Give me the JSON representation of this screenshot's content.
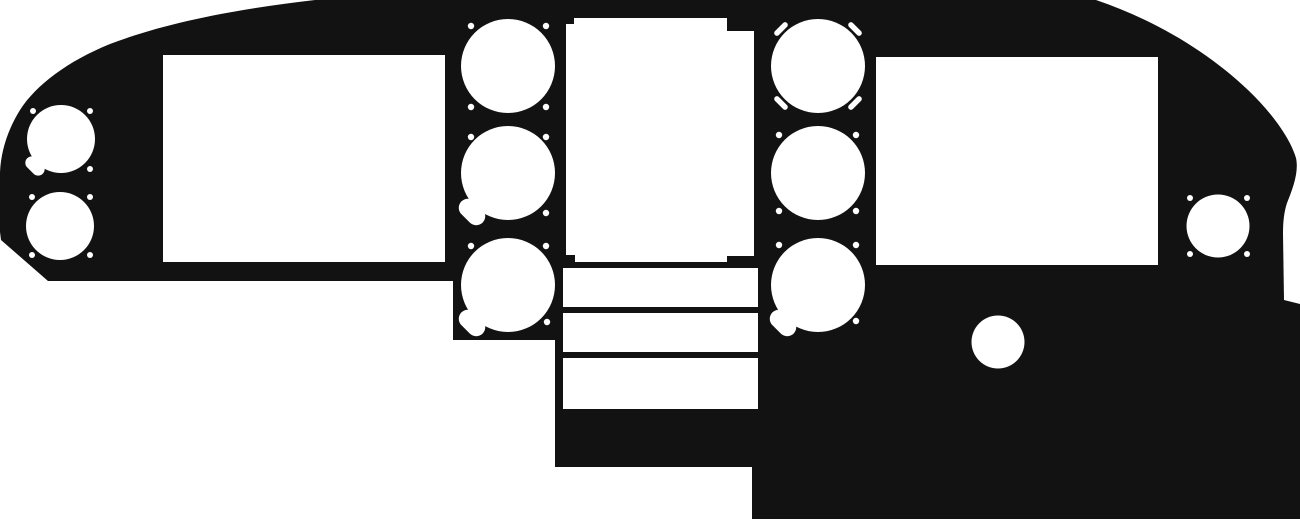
{
  "meta": {
    "title": "aircraft-instrument-panel-cutout-silhouette",
    "width": 1300,
    "height": 523
  },
  "colors": {
    "panel": "#121212",
    "cutout": "#ffffff",
    "background": "#ffffff"
  },
  "panel": {
    "outline_path": "M 315,0 L 1096,0 C 1155,20 1208,52 1248,90 C 1272,113 1290,138 1296,158 C 1299,172 1293,188 1287,203 C 1284,212 1283,222 1283,234 L 1284,300 L 1300,304 L 1300,519 L 752,519 L 752,467 L 555,467 L 555,340 L 453,340 L 453,281 L 48,281 L 1,240 L 0,232 L 0,172 C 1,152 7,131 20,110 C 36,85 68,61 110,44 C 168,22 238,9 315,0 Z",
    "display_cutouts": [
      {
        "name": "left-display-cutout",
        "x": 163,
        "y": 55,
        "w": 282,
        "h": 207
      },
      {
        "name": "right-display-cutout",
        "x": 876,
        "y": 57,
        "w": 282,
        "h": 208
      }
    ],
    "radio_stack": {
      "main": {
        "name": "radio-stack-cutout",
        "x": 566,
        "y": 18,
        "w": 188,
        "h": 244
      },
      "corner_notches": [
        {
          "name": "radio-notch-top-left",
          "x": 566,
          "y": 18,
          "w": 8,
          "h": 6
        },
        {
          "name": "radio-notch-top-right",
          "x": 727,
          "y": 18,
          "w": 27,
          "h": 13
        },
        {
          "name": "radio-notch-bottom-left",
          "x": 566,
          "y": 255,
          "w": 9,
          "h": 7
        },
        {
          "name": "radio-notch-bottom-right",
          "x": 727,
          "y": 256,
          "w": 27,
          "h": 6
        }
      ],
      "slots": [
        {
          "name": "radio-slot-1",
          "x": 563,
          "y": 268,
          "w": 195,
          "h": 39
        },
        {
          "name": "radio-slot-2",
          "x": 563,
          "y": 313,
          "w": 195,
          "h": 39
        },
        {
          "name": "radio-slot-3",
          "x": 563,
          "y": 358,
          "w": 195,
          "h": 51
        }
      ]
    },
    "instrument_cutouts": [
      {
        "name": "far-left-top-instrument",
        "cx": 61,
        "cy": 139,
        "r": 34,
        "notch": {
          "dx": -26,
          "dy": 27,
          "w": 22,
          "h": 13
        }
      },
      {
        "name": "far-left-bottom-instrument",
        "cx": 60,
        "cy": 226,
        "r": 34
      },
      {
        "name": "left-column-top-instrument",
        "cx": 508,
        "cy": 66,
        "r": 47
      },
      {
        "name": "left-column-mid-instrument",
        "cx": 508,
        "cy": 173,
        "r": 47,
        "notch": {
          "dx": -36,
          "dy": 39,
          "w": 30,
          "h": 18
        }
      },
      {
        "name": "left-column-bottom-instrument",
        "cx": 508,
        "cy": 285,
        "r": 47,
        "notch": {
          "dx": -36,
          "dy": 38,
          "w": 30,
          "h": 18
        }
      },
      {
        "name": "right-column-top-instrument",
        "cx": 818,
        "cy": 66,
        "r": 47,
        "corner_slots": true
      },
      {
        "name": "right-column-mid-instrument",
        "cx": 818,
        "cy": 173,
        "r": 47
      },
      {
        "name": "right-column-bottom-instrument",
        "cx": 818,
        "cy": 285,
        "r": 47,
        "notch": {
          "dx": -35,
          "dy": 38,
          "w": 30,
          "h": 18
        }
      },
      {
        "name": "far-right-instrument",
        "cx": 1218,
        "cy": 226,
        "r": 31.5
      }
    ],
    "corner_slot_spec": {
      "offset": 37,
      "w": 17,
      "h": 5.5
    },
    "fastener_holes": [
      {
        "name": "screw-hole",
        "cx": 33,
        "cy": 111,
        "r": 3
      },
      {
        "name": "screw-hole",
        "cx": 90,
        "cy": 111,
        "r": 3
      },
      {
        "name": "screw-hole",
        "cx": 90,
        "cy": 169,
        "r": 3
      },
      {
        "name": "screw-hole",
        "cx": 32,
        "cy": 197,
        "r": 3
      },
      {
        "name": "screw-hole",
        "cx": 90,
        "cy": 197,
        "r": 3
      },
      {
        "name": "screw-hole",
        "cx": 32,
        "cy": 255,
        "r": 3
      },
      {
        "name": "screw-hole",
        "cx": 90,
        "cy": 255,
        "r": 3
      },
      {
        "name": "screw-hole",
        "cx": 471,
        "cy": 26,
        "r": 3.2
      },
      {
        "name": "screw-hole",
        "cx": 546,
        "cy": 26,
        "r": 3.2
      },
      {
        "name": "screw-hole",
        "cx": 471,
        "cy": 107,
        "r": 3.2
      },
      {
        "name": "screw-hole",
        "cx": 546,
        "cy": 107,
        "r": 3.2
      },
      {
        "name": "screw-hole",
        "cx": 471,
        "cy": 137,
        "r": 3.2
      },
      {
        "name": "screw-hole",
        "cx": 546,
        "cy": 137,
        "r": 3.2
      },
      {
        "name": "screw-hole",
        "cx": 546,
        "cy": 213,
        "r": 3.2
      },
      {
        "name": "screw-hole",
        "cx": 471,
        "cy": 246,
        "r": 3.2
      },
      {
        "name": "screw-hole",
        "cx": 546,
        "cy": 246,
        "r": 3.2
      },
      {
        "name": "screw-hole",
        "cx": 547,
        "cy": 322,
        "r": 3.2
      },
      {
        "name": "screw-hole",
        "cx": 779,
        "cy": 135,
        "r": 3.2
      },
      {
        "name": "screw-hole",
        "cx": 856,
        "cy": 135,
        "r": 3.2
      },
      {
        "name": "screw-hole",
        "cx": 779,
        "cy": 211,
        "r": 3.2
      },
      {
        "name": "screw-hole",
        "cx": 856,
        "cy": 211,
        "r": 3.2
      },
      {
        "name": "screw-hole",
        "cx": 779,
        "cy": 245,
        "r": 3.2
      },
      {
        "name": "screw-hole",
        "cx": 856,
        "cy": 245,
        "r": 3.2
      },
      {
        "name": "screw-hole",
        "cx": 856,
        "cy": 321,
        "r": 3.2
      },
      {
        "name": "screw-hole",
        "cx": 1190,
        "cy": 198,
        "r": 3
      },
      {
        "name": "screw-hole",
        "cx": 1247,
        "cy": 198,
        "r": 3
      },
      {
        "name": "screw-hole",
        "cx": 1190,
        "cy": 254,
        "r": 3
      },
      {
        "name": "screw-hole",
        "cx": 1247,
        "cy": 254,
        "r": 3
      }
    ],
    "misc_holes": [
      {
        "name": "lower-right-round-hole",
        "cx": 998,
        "cy": 342,
        "r": 26.5
      }
    ]
  }
}
